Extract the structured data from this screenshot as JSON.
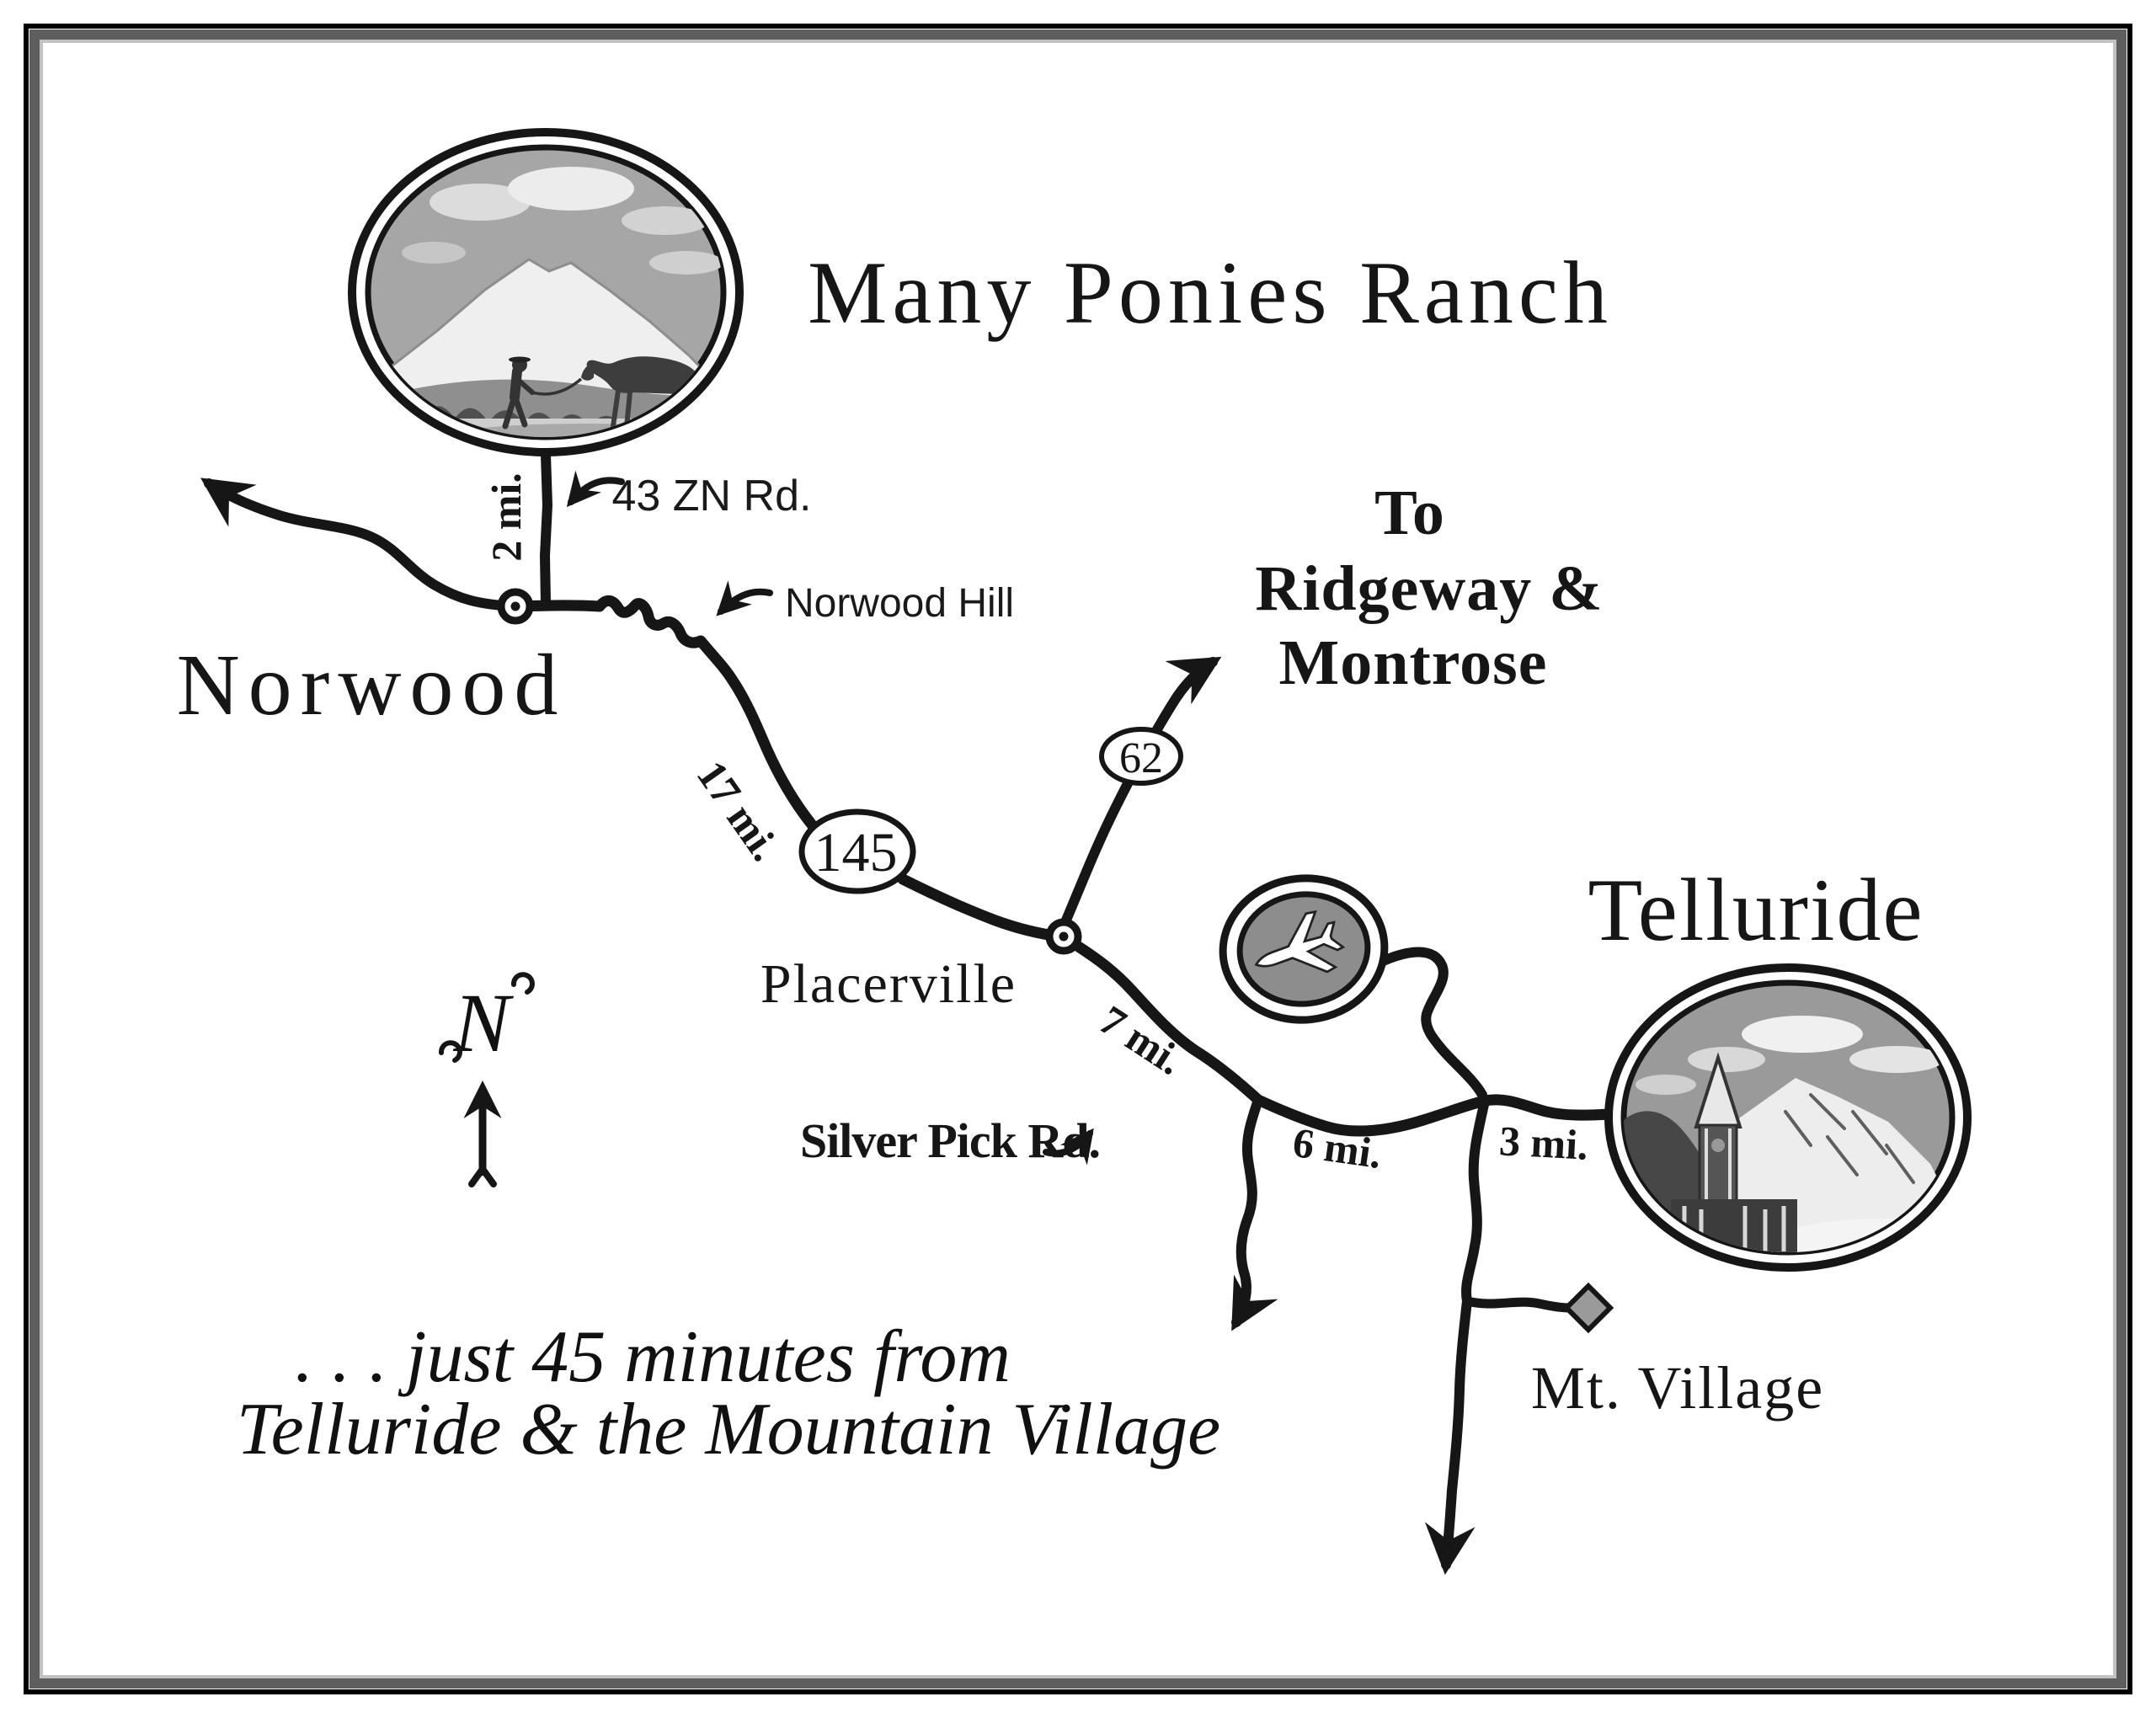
{
  "map": {
    "title": "Many Ponies Ranch",
    "compass": {
      "label": "N"
    },
    "towns": {
      "norwood": "Norwood",
      "placerville": "Placerville",
      "telluride": "Telluride",
      "mt_village": "Mt. Village"
    },
    "roads": {
      "zn_rd": "43 ZN Rd.",
      "norwood_hill": "Norwood Hill",
      "silver_pick_rd": "Silver Pick Rd."
    },
    "route_shields": {
      "hwy145": "145",
      "hwy62": "62"
    },
    "distances": {
      "ranch_to_norwood": "2 mi.",
      "norwood_to_placerville": "17 mi.",
      "placerville_to_silverpick": "7 mi.",
      "silverpick_to_village_turn": "6 mi.",
      "village_turn_to_telluride": "3 mi."
    },
    "destination_sign": {
      "line1": "To",
      "line2": "Ridgeway &",
      "line3": "Montrose"
    },
    "tagline": {
      "line1": ". . . just 45 minutes from",
      "line2": "Telluride & the Mountain Village"
    },
    "colors": {
      "ink": "#161616",
      "frame_dark": "#5e5e5e",
      "frame_light": "#c2c2c2",
      "sky_gray": "#a6a6a6",
      "airport_gray": "#8d8d8d",
      "marker_gray": "#9a9a9a"
    }
  }
}
